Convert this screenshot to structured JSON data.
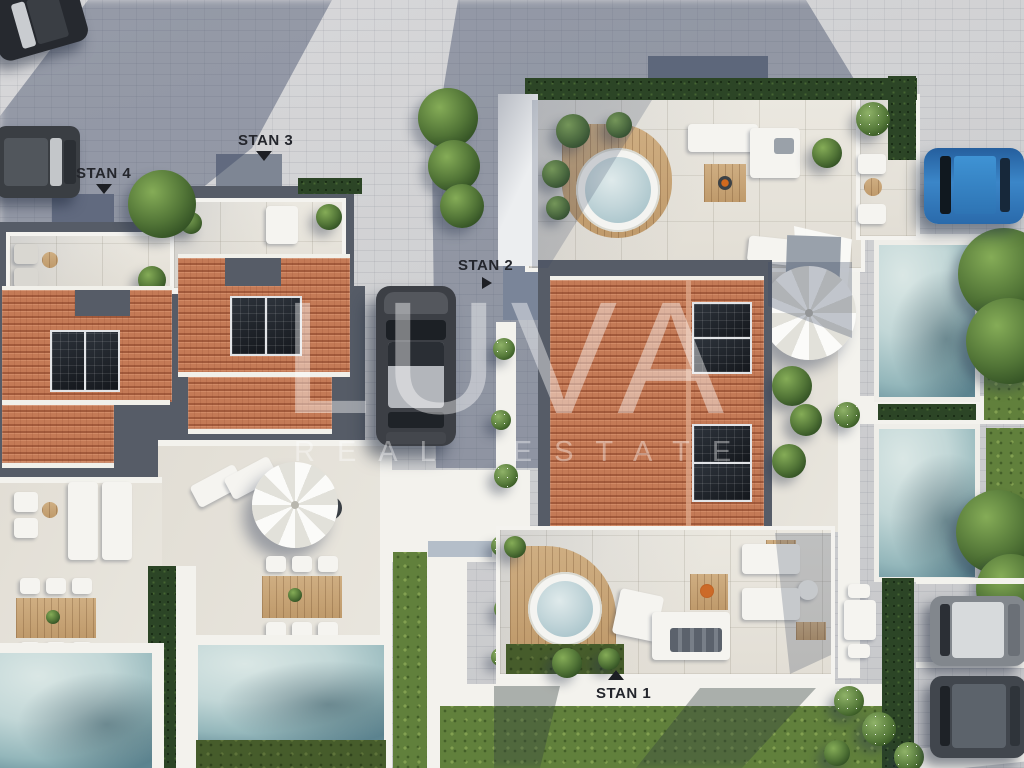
{
  "scene": {
    "description": "Aerial top-down 3D architectural render of a residential complex with four apartment units, rooftop terraces, hot tubs, swimming pools, gardens and parked cars"
  },
  "watermark": {
    "brand": "LUVA",
    "tagline": "REAL ESTATE",
    "color": "#ffffff",
    "opacity": 0.42
  },
  "labels": {
    "stan4": {
      "text": "STAN 4",
      "arrow": "down"
    },
    "stan3": {
      "text": "STAN 3",
      "arrow": "down"
    },
    "stan2": {
      "text": "STAN 2",
      "arrow": "right"
    },
    "stan1": {
      "text": "STAN 1",
      "arrow": "up"
    }
  },
  "palette": {
    "paver": "#cdced0",
    "paver_shadow": "#8b94a8",
    "terracotta_roof": "#c47a56",
    "roof_trim_gray": "#565c67",
    "solar_panel": "#20252c",
    "terrace": "#e9e6de",
    "wall_white": "#f4f3ef",
    "wood_deck": "#c9a97c",
    "pool_light": "#cfe2e1",
    "pool_deep": "#5f8793",
    "grass": "#61803c",
    "hedge": "#2c4526",
    "car_blue": "#2f74b8",
    "car_dark": "#3a3e43",
    "label_text": "#24262c"
  }
}
